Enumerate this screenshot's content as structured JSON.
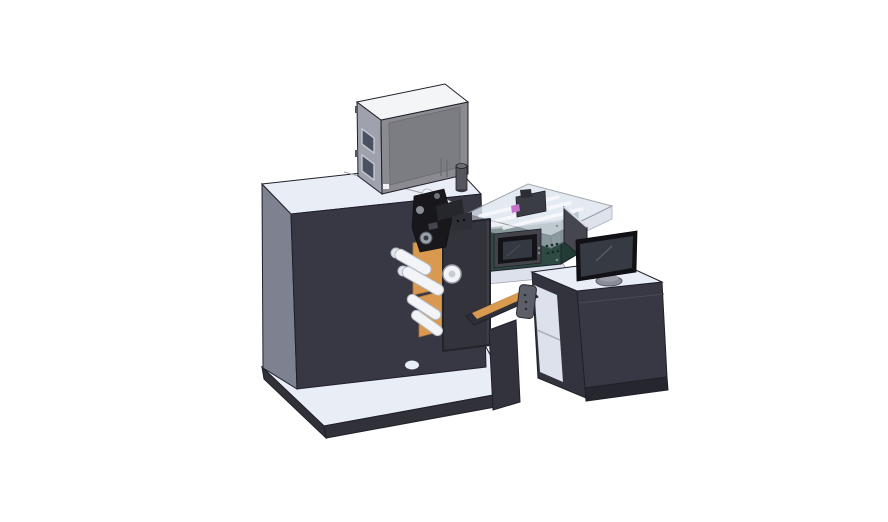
{
  "colors": {
    "background": "#ffffff",
    "face_top_light": "#e9edf6",
    "face_front_dark": "#383844",
    "face_side_gray": "#7d8190",
    "platform_band": "#31313a",
    "edge_dark": "#20202a",
    "seam_gray": "#9aa0ad",
    "dot_dark": "#14141a",
    "box_top": "#f4f5f7",
    "box_front": "#8a8a90",
    "box_front_panel": "#7c7c83",
    "box_side": "#9fa2ac",
    "box_window": "#4a5160",
    "window_frame": "#c8ccd4",
    "panel_border": "#6e6e75",
    "hinge_gray": "#55565e",
    "cylinder_gray": "#54555d",
    "cylinder_top": "#6a6b73",
    "cylinder_base": "#3f4047",
    "white_label": "#f0f1f4",
    "desk_interior": "#dce1ec",
    "cover_glass": "#dfe6f0",
    "cover_glass_side": "#c9d2de",
    "cover_edge": "#8e939e",
    "rail_white": "#f7f9fc",
    "mech_mid": "#3a3d44",
    "mech_top": "#2b2d33",
    "magenta_part": "#c873cb",
    "teal_front": "#2d4a43",
    "teal_side": "#213b35",
    "teal_edge": "#8fa39b",
    "teal_vent": "#182a25",
    "screw_teal": "#7e948c",
    "hmi_metal": "#43434a",
    "hmi_bezel": "#141418",
    "hmi_screen": "#343841",
    "hmi_sheen": "#4a5058",
    "hmi_button": "#8a8d96",
    "orange": "#d9994e",
    "orange_edge": "#a8733a",
    "station_plate": "#33333c",
    "plate_edge": "#23232b",
    "plate_highlight": "#4a4a55",
    "roller_white": "#f2f4f8",
    "roller_stroke": "#b6bcc8",
    "roller_cap": "#e2e6ee",
    "cap_inner": "#c9cdd6",
    "mech_black": "#17171c",
    "mech_dark2": "#26262d",
    "mech_dark3": "#2e2e36",
    "mech_dot": "#0c0c10",
    "metal_light": "#9aa0ab",
    "metal_ring": "#50525a",
    "metal_inner": "#3a3a42",
    "metal_mid": "#8a8d96",
    "metal_soft": "#70737c",
    "mech_detail": "#44444e",
    "column_dark": "#33333d",
    "arm_dark": "#2f2f38",
    "bracket_gray": "#5d5f68",
    "bracket_edge": "#2c2c33",
    "shelf_line": "#aab0bc",
    "desk_seam": "#4a4a55",
    "base_strip": "#26262e",
    "sidepanel_gray": "#46464f",
    "sidepanel_top": "#d5dae3",
    "stand_neck": "#75777f",
    "stand_gray": "#8b8e98",
    "stand_rim": "#55565e",
    "stand_top": "#9da0aa",
    "monitor_bezel": "#121216",
    "monitor_screen": "#363a42",
    "screen_sheen": "#596069"
  }
}
